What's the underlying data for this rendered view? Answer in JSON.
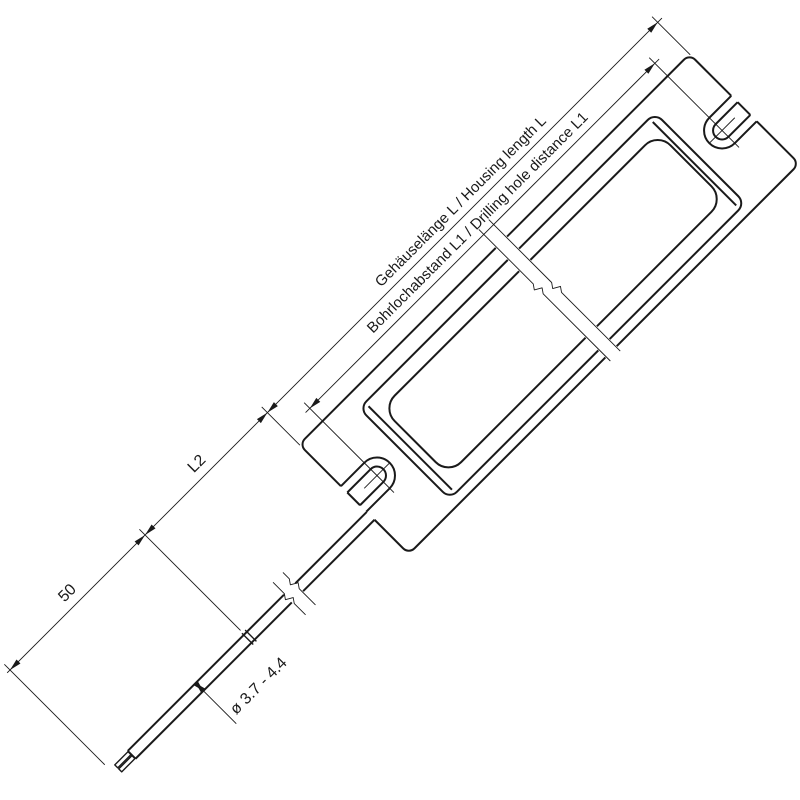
{
  "drawing": {
    "type": "technical-dimension-drawing",
    "subject": "LED driver housing with mounting slots and connection cable",
    "labels": {
      "housing_length": "Gehäuselänge L / Housing length L",
      "hole_distance": "Bohrlochabstand L1 / Drilling hole distance L1",
      "l2": "L2",
      "cable_end_length": "50",
      "cable_diameter": "ø 3.7 - 4.4"
    },
    "colors": {
      "line": "#1a1a1a",
      "background": "#ffffff"
    }
  }
}
